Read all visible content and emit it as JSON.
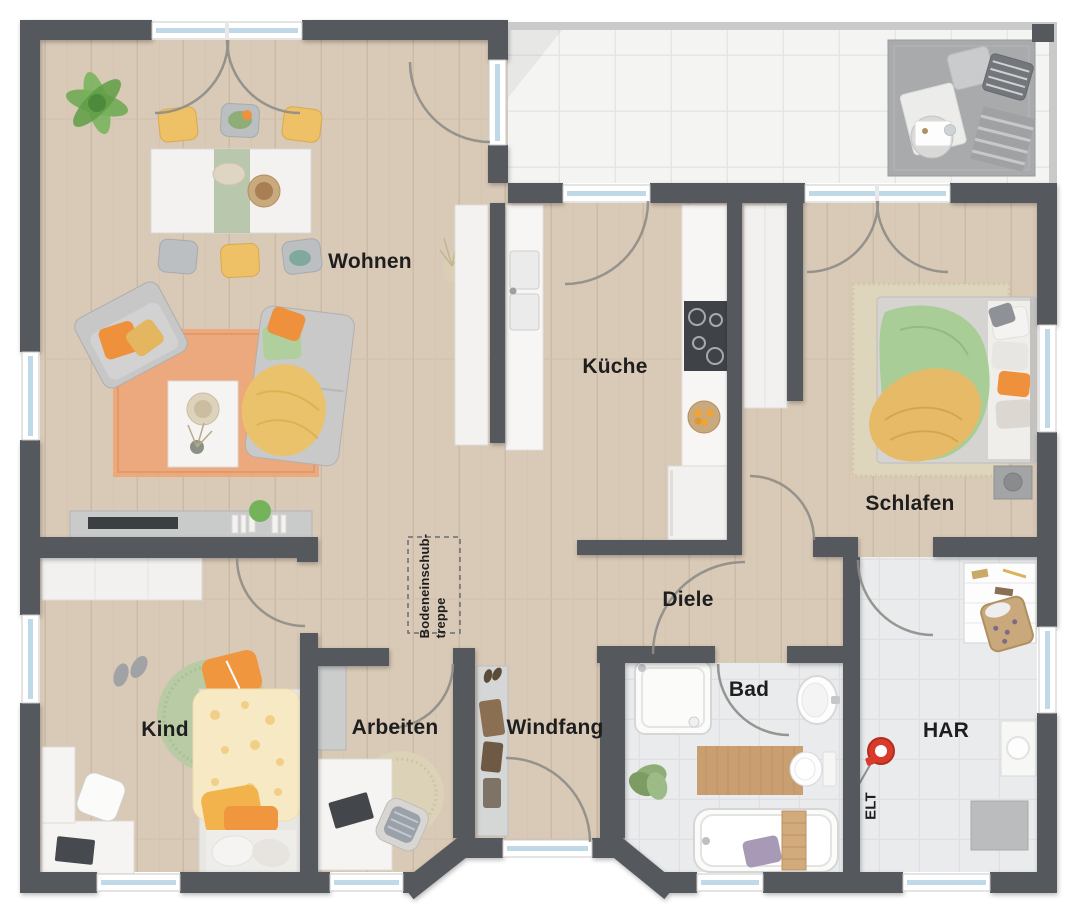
{
  "plan": {
    "rooms": {
      "wohnen": {
        "label": "Wohnen"
      },
      "kueche": {
        "label": "Küche"
      },
      "schlafen": {
        "label": "Schlafen"
      },
      "diele": {
        "label": "Diele"
      },
      "kind": {
        "label": "Kind"
      },
      "arbeiten": {
        "label": "Arbeiten"
      },
      "windfang": {
        "label": "Windfang"
      },
      "bad": {
        "label": "Bad"
      },
      "har": {
        "label": "HAR"
      },
      "elt": {
        "label": "ELT"
      },
      "attic_hatch": {
        "line1": "Bodeneinschub-",
        "line2": "treppe"
      }
    },
    "colors": {
      "wall": "#55585c",
      "wood_floor": "#d9c9b7",
      "terrace_tile": "#f4f4f3",
      "gray_tile": "#eaebed",
      "window_glass": "#bfd9e8",
      "accent_orange": "#ef913c",
      "accent_green": "#a9cd97",
      "accent_yellow": "#e7ba67",
      "meter_red": "#d93a2b"
    }
  }
}
